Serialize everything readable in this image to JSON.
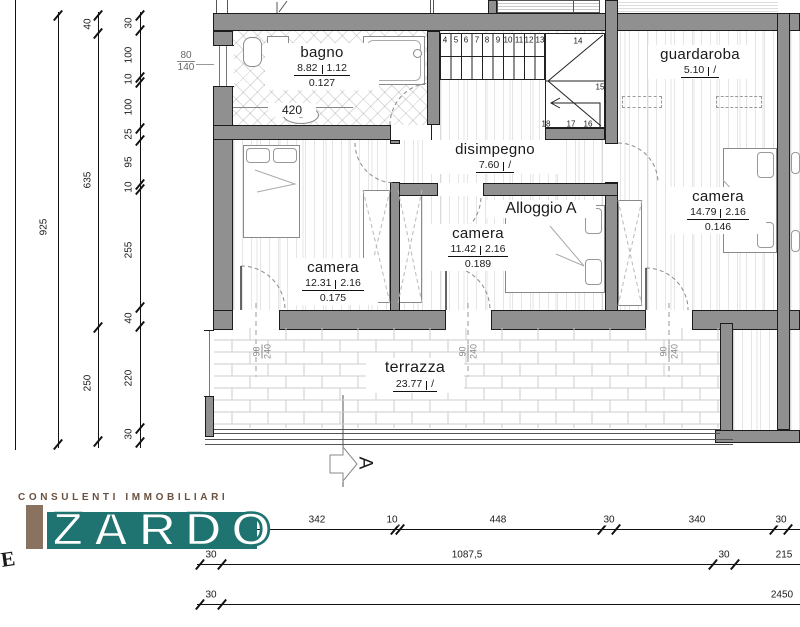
{
  "plan": {
    "unit_label": "Alloggio A",
    "rooms": [
      {
        "name": "bagno",
        "area": "8.82",
        "coeff": "1.12",
        "ratio": "0.127"
      },
      {
        "name": "disimpegno",
        "area": "7.60",
        "coeff": "/",
        "ratio": ""
      },
      {
        "name": "guardaroba",
        "area": "5.10",
        "coeff": "/",
        "ratio": ""
      },
      {
        "name": "camera",
        "area": "12.31",
        "coeff": "2.16",
        "ratio": "0.175"
      },
      {
        "name": "camera",
        "area": "11.42",
        "coeff": "2.16",
        "ratio": "0.189"
      },
      {
        "name": "camera",
        "area": "14.79",
        "coeff": "2.16",
        "ratio": "0.146"
      },
      {
        "name": "terrazza",
        "area": "23.77",
        "coeff": "/",
        "ratio": ""
      }
    ],
    "bagno_width": "420",
    "window_label": {
      "top": "80",
      "bottom": "140"
    },
    "door_label": {
      "width": "90",
      "height": "240"
    },
    "stairs": {
      "steps": [
        "4",
        "5",
        "6",
        "7",
        "8",
        "9",
        "10",
        "11",
        "12",
        "13"
      ],
      "landing": [
        "14",
        "15",
        "16",
        "17",
        "18"
      ]
    },
    "section_marker": "A"
  },
  "dimensions": {
    "left_outer": [
      "925"
    ],
    "left_mid": [
      "40",
      "635",
      "250"
    ],
    "left_inner": [
      "30",
      "100",
      "10",
      "100",
      "25",
      "95",
      "10",
      "255",
      "40",
      "220",
      "30"
    ],
    "bottom_row1": [
      "30",
      "40",
      "342",
      "10",
      "448",
      "30",
      "340",
      "30"
    ],
    "bottom_row2": [
      "30",
      "1087,5",
      "30",
      "215"
    ],
    "bottom_row3": [
      "30",
      "2450"
    ]
  },
  "logo": {
    "tagline": "CONSULENTI IMMOBILIARI",
    "name": "ZARDO",
    "stray_letter": "E",
    "colors": {
      "teal": "#1f7370",
      "tan": "#8a7260",
      "brown": "#6b5140"
    }
  }
}
